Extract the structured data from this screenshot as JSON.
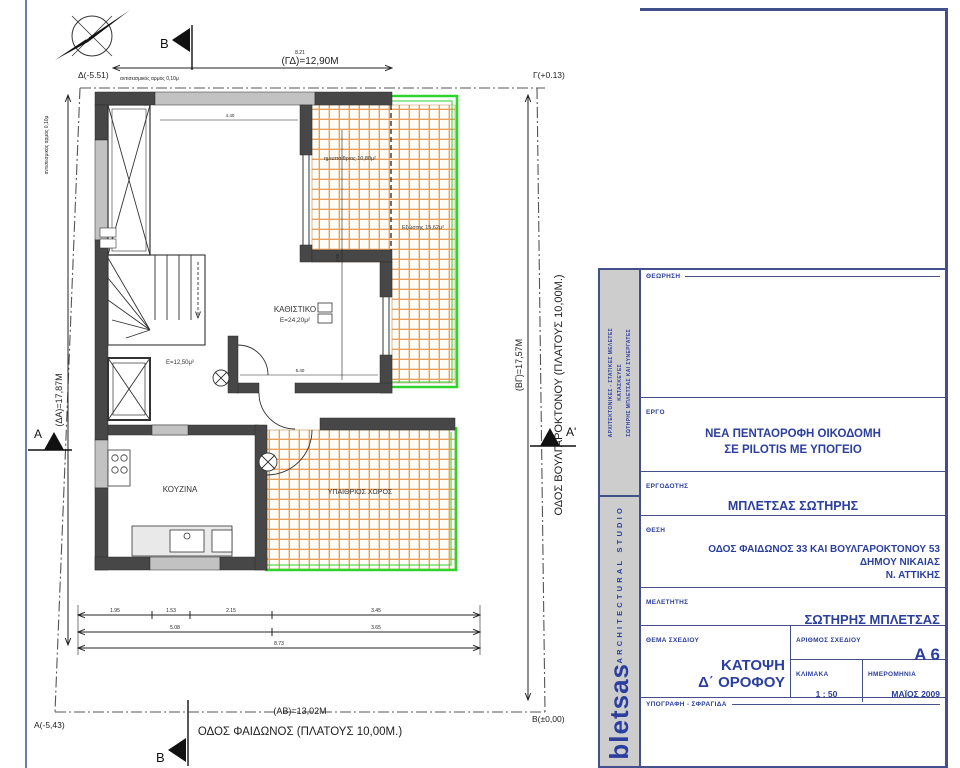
{
  "colors": {
    "accent_blue": "#2b3f9e",
    "border_blue": "#44508c",
    "railing_green": "#2ed32e",
    "tile_orange": "#e8a05c",
    "wall_dark": "#474747",
    "wall_light": "#c2c2c2"
  },
  "plan": {
    "north": {
      "letter": "E"
    },
    "sections": {
      "b_top": "B",
      "b_bottom": "B",
      "a_left": "A",
      "a_right": "A'"
    },
    "corners": {
      "d": "Δ(-5.51)",
      "g": "Γ(+0.13)",
      "a": "Α(-5,43)",
      "b": "Β(±0,00)"
    },
    "dims": {
      "top": "(ΓΔ)=12,90Μ",
      "left": "(ΔΑ)=17,87Μ",
      "right": "(ΒΓ)=17,57Μ",
      "bottom": "(ΑΒ)=13,02Μ",
      "top_small": "8.21",
      "joint": "αντισεισμικός αρμός 0,10μ",
      "c1a": "1.95",
      "c1b": "1.53",
      "c1c": "2.15",
      "c1d": "3.45",
      "c2a": "5.08",
      "c2b": "3.65",
      "c3a": "8.73",
      "i1": "4.40",
      "i2": "4.50",
      "i3": "5.40"
    },
    "streets": {
      "bottom": "ΟΔΟΣ ΦΑΙΔΩΝΟΣ (ΠΛΑΤΟΥΣ 10,00Μ.)",
      "right": "ΟΔΟΣ ΒΟΥΛΓΑΡΟΚΤΟΝΟΥ (ΠΛΑΤΟΥΣ 10,00Μ.)"
    },
    "rooms": {
      "living": "ΚΑΘΙΣΤΙΚΟ",
      "living_area": "Ε=24,20μ²",
      "kitchen": "ΚΟΥΖΙΝΑ",
      "hall_area": "Ε=12,50μ²",
      "open_space": "ΥΠΑΙΘΡΙΟΣ ΧΩΡΟΣ",
      "semi_open": "ημιυπαίθριος 10,80μ²",
      "balcony": "Εξώστης 15,62μ²"
    }
  },
  "titleblock": {
    "sidebar": {
      "line1": "ΑΡΧΙΤΕΚΤΟΝΙΚΕΣ - ΣΤΑΤΙΚΕΣ ΜΕΛΕΤΕΣ",
      "line2": "ΚΑΤΑΣΚΕΥΕΣ",
      "line3": "ΣΩΤΗΡΗΣ ΜΠΛΕΤΣΑΣ ΚΑΙ ΣΥΝΕΡΓΑΤΕΣ",
      "studio": "ARCHITECTURAL STUDIO",
      "brand": "bletsas"
    },
    "fields": {
      "theorisi_label": "ΘΕΩΡΗΣΗ",
      "ergo_label": "ΕΡΓΟ",
      "ergo_value_1": "ΝΕΑ ΠΕΝΤΑΟΡΟΦΗ ΟΙΚΟΔΟΜΗ",
      "ergo_value_2": "ΣΕ PILOTIS ΜΕ ΥΠΟΓΕΙΟ",
      "ergodotis_label": "ΕΡΓΟΔΟΤΗΣ",
      "ergodotis_value": "ΜΠΛΕΤΣΑΣ ΣΩΤΗΡΗΣ",
      "thesi_label": "ΘΕΣΗ",
      "thesi_value_1": "ΟΔΟΣ ΦΑΙΔΩΝΟΣ 33 ΚΑΙ ΒΟΥΛΓΑΡΟΚΤΟΝΟΥ 53",
      "thesi_value_2": "ΔΗΜΟΥ ΝΙΚΑΙΑΣ",
      "thesi_value_3": "Ν. ΑΤΤΙΚΗΣ",
      "meletitis_label": "ΜΕΛΕΤΗΤΗΣ",
      "meletitis_value": "ΣΩΤΗΡΗΣ ΜΠΛΕΤΣΑΣ",
      "thema_label": "ΘΕΜΑ ΣΧΕΔΙΟΥ",
      "thema_value_1": "ΚΑΤΟΨΗ",
      "thema_value_2": "Δ΄ ΟΡΟΦΟΥ",
      "arithmos_label": "ΑΡΙΘΜΟΣ ΣΧΕΔΙΟΥ",
      "arithmos_value": "A 6",
      "klimaka_label": "ΚΛΙΜΑΚΑ",
      "klimaka_value": "1 : 50",
      "imerominia_label": "ΗΜΕΡΟΜΗΝΙΑ",
      "imerominia_value": "ΜΑΪΟΣ 2009",
      "ypografi_label": "ΥΠΟΓΡΑΦΗ - ΣΦΡΑΓΙΔΑ"
    }
  }
}
